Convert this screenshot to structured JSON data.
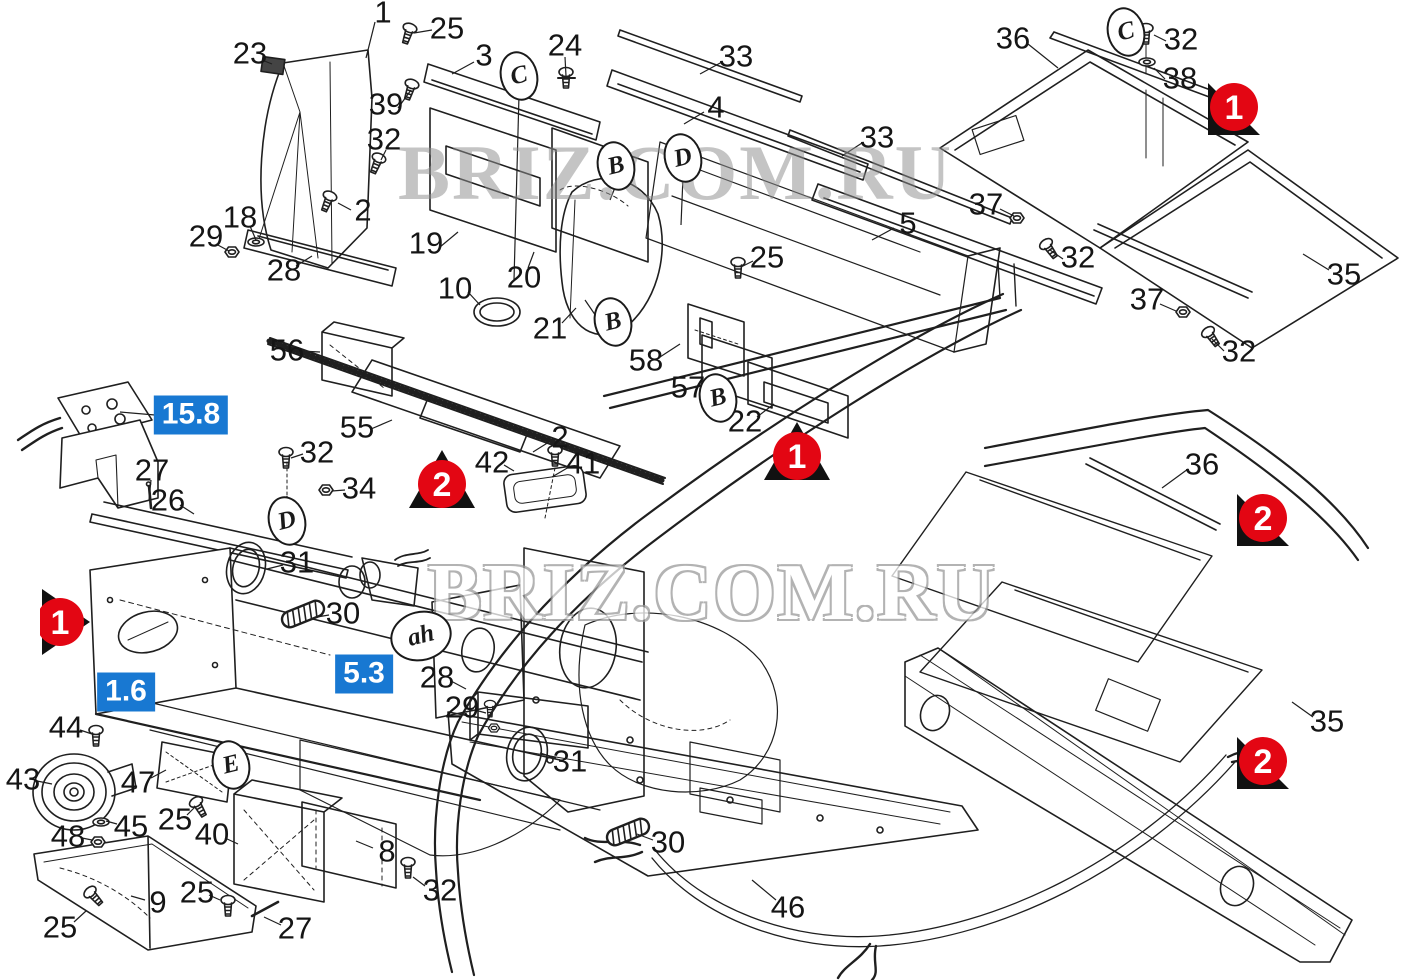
{
  "colors": {
    "red": "#e30613",
    "blue": "#1878d2",
    "line": "#1f1f1f",
    "watermark_gray": "#9a9a9a"
  },
  "watermarks": [
    {
      "text": "BRIZ.COM.RU",
      "x": 398,
      "y": 128,
      "size": 78,
      "style": "solid"
    },
    {
      "text": "BRIZ.COM.RU",
      "x": 428,
      "y": 548,
      "size": 80,
      "style": "outline"
    }
  ],
  "callouts": [
    {
      "n": "1",
      "x": 383,
      "y": 12,
      "sx": 375,
      "sy": 22,
      "tx": 366,
      "ty": 58
    },
    {
      "n": "25",
      "x": 447,
      "y": 28,
      "sx": 432,
      "sy": 30,
      "tx": 414,
      "ty": 33
    },
    {
      "n": "23",
      "x": 250,
      "y": 53,
      "sx": 262,
      "sy": 60,
      "tx": 272,
      "ty": 64
    },
    {
      "n": "3",
      "x": 484,
      "y": 55,
      "sx": 474,
      "sy": 62,
      "tx": 452,
      "ty": 74
    },
    {
      "n": "24",
      "x": 565,
      "y": 45,
      "sx": 565,
      "sy": 57,
      "tx": 566,
      "ty": 76
    },
    {
      "n": "39",
      "x": 386,
      "y": 104,
      "sx": 398,
      "sy": 108,
      "tx": 411,
      "ty": 90
    },
    {
      "n": "32",
      "x": 384,
      "y": 139,
      "sx": 386,
      "sy": 150,
      "tx": 381,
      "ty": 160
    },
    {
      "n": "2",
      "x": 363,
      "y": 210,
      "sx": 351,
      "sy": 210,
      "tx": 338,
      "ty": 203
    },
    {
      "n": "18",
      "x": 240,
      "y": 217,
      "sx": 250,
      "sy": 226,
      "tx": 256,
      "ty": 240
    },
    {
      "n": "29",
      "x": 206,
      "y": 236,
      "sx": 216,
      "sy": 244,
      "tx": 229,
      "ty": 251
    },
    {
      "n": "28",
      "x": 284,
      "y": 270,
      "sx": 296,
      "sy": 266,
      "tx": 312,
      "ty": 256
    },
    {
      "n": "19",
      "x": 426,
      "y": 243,
      "sx": 440,
      "sy": 247,
      "tx": 458,
      "ty": 232
    },
    {
      "n": "10",
      "x": 455,
      "y": 288,
      "sx": 468,
      "sy": 292,
      "tx": 480,
      "ty": 305
    },
    {
      "n": "20",
      "x": 524,
      "y": 277,
      "sx": 528,
      "sy": 268,
      "tx": 534,
      "ty": 252
    },
    {
      "n": "21",
      "x": 550,
      "y": 328,
      "sx": 562,
      "sy": 323,
      "tx": 576,
      "ty": 308
    },
    {
      "n": "33",
      "x": 736,
      "y": 56,
      "sx": 722,
      "sy": 62,
      "tx": 700,
      "ty": 74
    },
    {
      "n": "4",
      "x": 716,
      "y": 107,
      "sx": 704,
      "sy": 112,
      "tx": 684,
      "ty": 124
    },
    {
      "n": "33",
      "x": 877,
      "y": 137,
      "sx": 862,
      "sy": 143,
      "tx": 842,
      "ty": 156
    },
    {
      "n": "5",
      "x": 908,
      "y": 223,
      "sx": 894,
      "sy": 228,
      "tx": 872,
      "ty": 240
    },
    {
      "n": "25",
      "x": 767,
      "y": 257,
      "sx": 753,
      "sy": 261,
      "tx": 741,
      "ty": 267
    },
    {
      "n": "37",
      "x": 986,
      "y": 204,
      "sx": 1000,
      "sy": 209,
      "tx": 1014,
      "ty": 216
    },
    {
      "n": "36",
      "x": 1013,
      "y": 38,
      "sx": 1028,
      "sy": 44,
      "tx": 1058,
      "ty": 68
    },
    {
      "n": "32",
      "x": 1181,
      "y": 39,
      "sx": 1166,
      "sy": 41,
      "tx": 1154,
      "ty": 35
    },
    {
      "n": "38",
      "x": 1180,
      "y": 78,
      "sx": 1165,
      "sy": 79,
      "tx": 1154,
      "ty": 68
    },
    {
      "n": "32",
      "x": 1078,
      "y": 257,
      "sx": 1063,
      "sy": 259,
      "tx": 1050,
      "ty": 250
    },
    {
      "n": "35",
      "x": 1344,
      "y": 274,
      "sx": 1329,
      "sy": 270,
      "tx": 1303,
      "ty": 254
    },
    {
      "n": "37",
      "x": 1147,
      "y": 299,
      "sx": 1160,
      "sy": 304,
      "tx": 1176,
      "ty": 311
    },
    {
      "n": "32",
      "x": 1239,
      "y": 351,
      "sx": 1224,
      "sy": 351,
      "tx": 1212,
      "ty": 339
    },
    {
      "n": "56",
      "x": 287,
      "y": 350,
      "sx": 300,
      "sy": 351,
      "tx": 320,
      "ty": 352
    },
    {
      "n": "55",
      "x": 357,
      "y": 427,
      "sx": 371,
      "sy": 429,
      "tx": 392,
      "ty": 420
    },
    {
      "n": "58",
      "x": 646,
      "y": 360,
      "sx": 660,
      "sy": 357,
      "tx": 680,
      "ty": 344
    },
    {
      "n": "57",
      "x": 688,
      "y": 387,
      "sx": 701,
      "sy": 384,
      "tx": 716,
      "ty": 374
    },
    {
      "n": "22",
      "x": 745,
      "y": 421,
      "sx": 757,
      "sy": 417,
      "tx": 774,
      "ty": 404
    },
    {
      "n": "27",
      "x": 152,
      "y": 470,
      "sx": 151,
      "sy": 480,
      "tx": 149,
      "ty": 500
    },
    {
      "n": "26",
      "x": 168,
      "y": 500,
      "sx": 180,
      "sy": 505,
      "tx": 194,
      "ty": 514
    },
    {
      "n": "32",
      "x": 317,
      "y": 452,
      "sx": 303,
      "sy": 454,
      "tx": 291,
      "ty": 458
    },
    {
      "n": "34",
      "x": 359,
      "y": 488,
      "sx": 345,
      "sy": 490,
      "tx": 332,
      "ty": 491
    },
    {
      "n": "31",
      "x": 297,
      "y": 562,
      "sx": 283,
      "sy": 565,
      "tx": 267,
      "ty": 569
    },
    {
      "n": "30",
      "x": 343,
      "y": 613,
      "sx": 329,
      "sy": 615,
      "tx": 317,
      "ty": 617
    },
    {
      "n": "2",
      "x": 560,
      "y": 437,
      "sx": 549,
      "sy": 442,
      "tx": 533,
      "ty": 452
    },
    {
      "n": "42",
      "x": 492,
      "y": 462,
      "sx": 504,
      "sy": 465,
      "tx": 514,
      "ty": 471
    },
    {
      "n": "41",
      "x": 583,
      "y": 463,
      "sx": 569,
      "sy": 467,
      "tx": 552,
      "ty": 477
    },
    {
      "n": "36",
      "x": 1202,
      "y": 464,
      "sx": 1188,
      "sy": 469,
      "tx": 1162,
      "ty": 488
    },
    {
      "n": "35",
      "x": 1327,
      "y": 721,
      "sx": 1313,
      "sy": 717,
      "tx": 1292,
      "ty": 702
    },
    {
      "n": "44",
      "x": 66,
      "y": 727,
      "sx": 80,
      "sy": 730,
      "tx": 92,
      "ty": 734
    },
    {
      "n": "43",
      "x": 23,
      "y": 779,
      "sx": 37,
      "sy": 781,
      "tx": 52,
      "ty": 784
    },
    {
      "n": "47",
      "x": 138,
      "y": 782,
      "sx": 151,
      "sy": 778,
      "tx": 166,
      "ty": 770
    },
    {
      "n": "45",
      "x": 131,
      "y": 826,
      "sx": 117,
      "sy": 824,
      "tx": 106,
      "ty": 821
    },
    {
      "n": "48",
      "x": 68,
      "y": 836,
      "sx": 82,
      "sy": 838,
      "tx": 92,
      "ty": 840
    },
    {
      "n": "25",
      "x": 175,
      "y": 819,
      "sx": 187,
      "sy": 815,
      "tx": 195,
      "ty": 807
    },
    {
      "n": "40",
      "x": 212,
      "y": 834,
      "sx": 225,
      "sy": 838,
      "tx": 238,
      "ty": 844
    },
    {
      "n": "8",
      "x": 387,
      "y": 851,
      "sx": 373,
      "sy": 848,
      "tx": 356,
      "ty": 841
    },
    {
      "n": "9",
      "x": 158,
      "y": 902,
      "sx": 145,
      "sy": 900,
      "tx": 131,
      "ty": 896
    },
    {
      "n": "25",
      "x": 60,
      "y": 927,
      "sx": 74,
      "sy": 922,
      "tx": 86,
      "ty": 911
    },
    {
      "n": "25",
      "x": 197,
      "y": 892,
      "sx": 209,
      "sy": 895,
      "tx": 220,
      "ty": 900
    },
    {
      "n": "27",
      "x": 295,
      "y": 928,
      "sx": 281,
      "sy": 925,
      "tx": 264,
      "ty": 917
    },
    {
      "n": "32",
      "x": 440,
      "y": 890,
      "sx": 425,
      "sy": 886,
      "tx": 413,
      "ty": 877
    },
    {
      "n": "28",
      "x": 437,
      "y": 677,
      "sx": 451,
      "sy": 681,
      "tx": 466,
      "ty": 689
    },
    {
      "n": "29",
      "x": 462,
      "y": 707,
      "sx": 475,
      "sy": 710,
      "tx": 486,
      "ty": 713
    },
    {
      "n": "31",
      "x": 570,
      "y": 761,
      "sx": 556,
      "sy": 758,
      "tx": 540,
      "ty": 753
    },
    {
      "n": "30",
      "x": 668,
      "y": 842,
      "sx": 653,
      "sy": 840,
      "tx": 637,
      "ty": 834
    },
    {
      "n": "46",
      "x": 788,
      "y": 907,
      "sx": 776,
      "sy": 900,
      "tx": 752,
      "ty": 880
    }
  ],
  "letters": [
    {
      "ch": "C",
      "x": 519,
      "y": 76,
      "w": 34,
      "h": 46,
      "tx": 514,
      "ty": 280
    },
    {
      "ch": "B",
      "x": 616,
      "y": 166,
      "w": 34,
      "h": 46,
      "tx": 610,
      "ty": 200
    },
    {
      "ch": "D",
      "x": 683,
      "y": 158,
      "w": 34,
      "h": 46,
      "tx": 681,
      "ty": 225
    },
    {
      "ch": "B",
      "x": 613,
      "y": 322,
      "w": 34,
      "h": 46,
      "tx": 585,
      "ty": 300
    },
    {
      "ch": "B",
      "x": 718,
      "y": 398,
      "w": 34,
      "h": 46
    },
    {
      "ch": "D",
      "x": 287,
      "y": 521,
      "w": 34,
      "h": 46,
      "tx": 287,
      "ty": 496
    },
    {
      "ch": "C",
      "x": 1126,
      "y": 32,
      "w": 34,
      "h": 46,
      "tx": 1141,
      "ty": 38
    },
    {
      "ch": "E",
      "x": 231,
      "y": 765,
      "w": 34,
      "h": 46,
      "tx": 249,
      "ty": 770
    },
    {
      "ch": "ah",
      "x": 421,
      "y": 636,
      "w": 58,
      "h": 46,
      "tx": 448,
      "ty": 643
    }
  ],
  "markers": [
    {
      "n": "1",
      "shape": "right",
      "x": 66,
      "y": 622
    },
    {
      "n": "1",
      "shape": "up",
      "x": 797,
      "y": 451
    },
    {
      "n": "1",
      "shape": "corner",
      "x": 1233,
      "y": 110
    },
    {
      "n": "2",
      "shape": "up",
      "x": 442,
      "y": 479
    },
    {
      "n": "2",
      "shape": "corner",
      "x": 1262,
      "y": 521
    },
    {
      "n": "2",
      "shape": "corner",
      "x": 1262,
      "y": 764
    }
  ],
  "refs": [
    {
      "text": "15.8",
      "x": 191,
      "y": 415,
      "sx": 155,
      "sy": 415,
      "tx": 120,
      "ty": 412
    },
    {
      "text": "1.6",
      "x": 126,
      "y": 692
    },
    {
      "text": "5.3",
      "x": 364,
      "y": 674
    }
  ]
}
